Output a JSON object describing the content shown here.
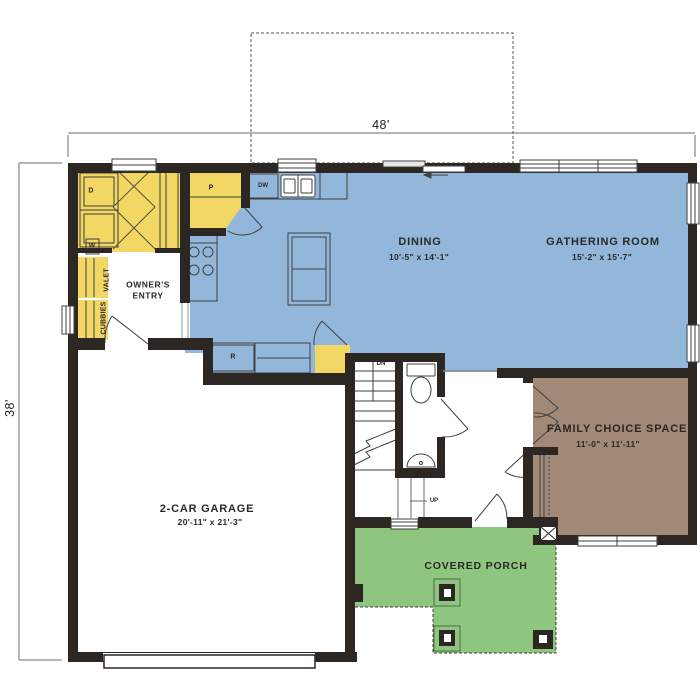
{
  "plan": {
    "dimensions": {
      "width": "48'",
      "height": "38'"
    },
    "rooms": {
      "dining": {
        "name": "DINING",
        "size": "10'-5\" x 14'-1\""
      },
      "gathering_room": {
        "name": "GATHERING ROOM",
        "size": "15'-2\" x 15'-7\""
      },
      "family_choice_space": {
        "name": "FAMILY CHOICE SPACE",
        "size": "11'-0\" x 11'-11\""
      },
      "garage": {
        "name": "2-CAR GARAGE",
        "size": "20'-11\" x 21'-3\""
      },
      "covered_porch": {
        "name": "COVERED PORCH"
      },
      "owners_entry": {
        "name": "OWNER'S ENTRY"
      }
    },
    "fixture_labels": {
      "pantry": "P",
      "dishwasher": "DW",
      "refrigerator": "R",
      "dryer": "D",
      "washer": "W",
      "valet": "VALET",
      "cubbies": "CUBBIES",
      "stairs_down": "DN",
      "stairs_up": "UP"
    },
    "colors": {
      "living_area_blue": "#93b7da",
      "storage_yellow": "#f2d765",
      "porch_green": "#8fc67f",
      "flex_room_brown": "#a28977",
      "wall": "#2d2724"
    }
  }
}
